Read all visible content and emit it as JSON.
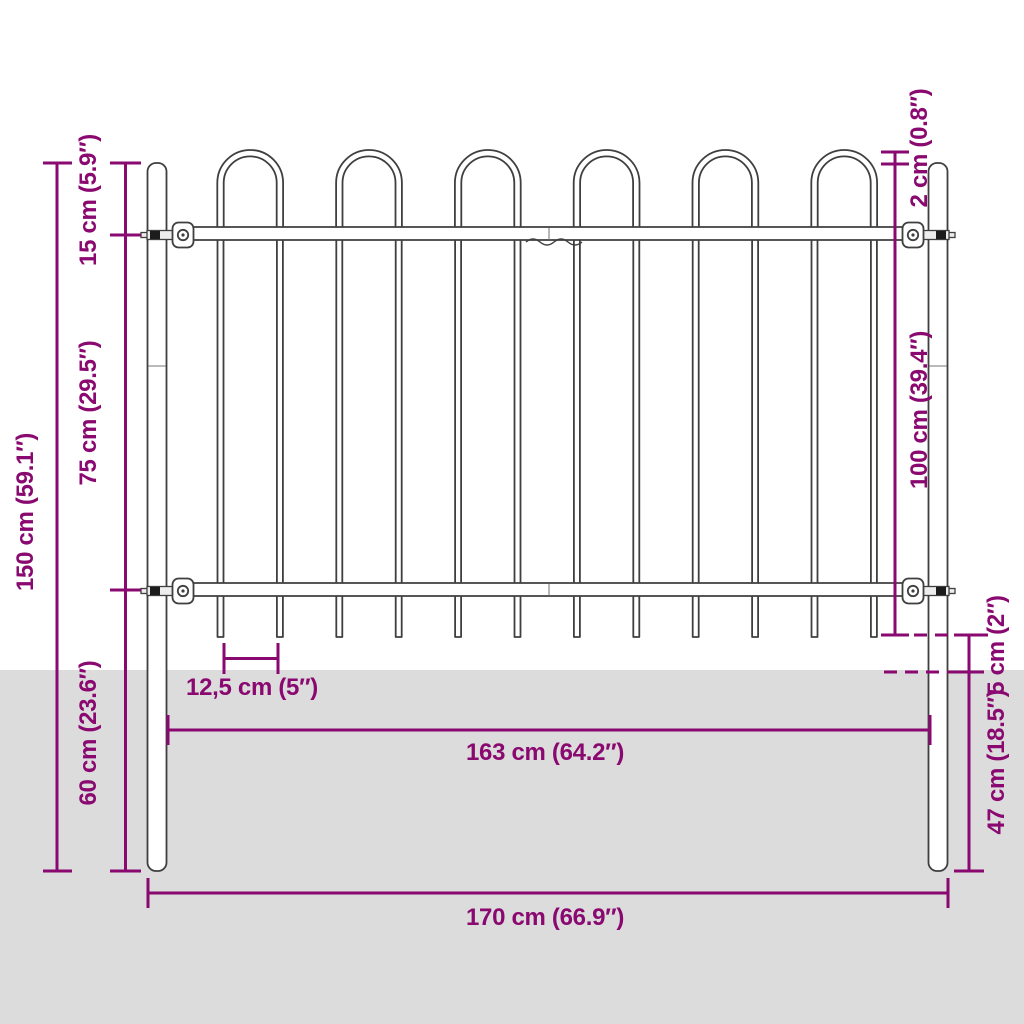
{
  "diagram_type": "fence-dimension-drawing",
  "product": "steel garden fence panel with hoop top and ground spikes",
  "colors": {
    "accent": "#8a0970",
    "fence_outline": "#3f3f3f",
    "ground": "#dcdcdc",
    "background": "#ffffff"
  },
  "dimensions": {
    "total_height": {
      "label": "150 cm (59.1″)",
      "value_cm": 150,
      "value_inch": 59.1
    },
    "hoop_to_rail": {
      "label": "15 cm (5.9″)",
      "value_cm": 15,
      "value_inch": 5.9
    },
    "rail_spacing": {
      "label": "75 cm (29.5″)",
      "value_cm": 75,
      "value_inch": 29.5
    },
    "post_below_rail": {
      "label": "60 cm (23.6″)",
      "value_cm": 60,
      "value_inch": 23.6
    },
    "hoop_above_post": {
      "label": "2 cm (0.8″)",
      "value_cm": 2,
      "value_inch": 0.8
    },
    "panel_height": {
      "label": "100 cm (39.4″)",
      "value_cm": 100,
      "value_inch": 39.4
    },
    "spike_clearance": {
      "label": "5 cm (2″)",
      "value_cm": 5,
      "value_inch": 2
    },
    "underground": {
      "label": "47 cm (18.5″)",
      "value_cm": 47,
      "value_inch": 18.5
    },
    "bar_spacing": {
      "label": "12,5 cm (5″)",
      "value_cm": 12.5,
      "value_inch": 5
    },
    "panel_width": {
      "label": "163 cm (64.2″)",
      "value_cm": 163,
      "value_inch": 64.2
    },
    "total_width": {
      "label": "170 cm (66.9″)",
      "value_cm": 170,
      "value_inch": 66.9
    }
  },
  "fence_structure": {
    "hoops": 6,
    "vertical_bars": 12,
    "rails": 2,
    "posts": 2
  }
}
